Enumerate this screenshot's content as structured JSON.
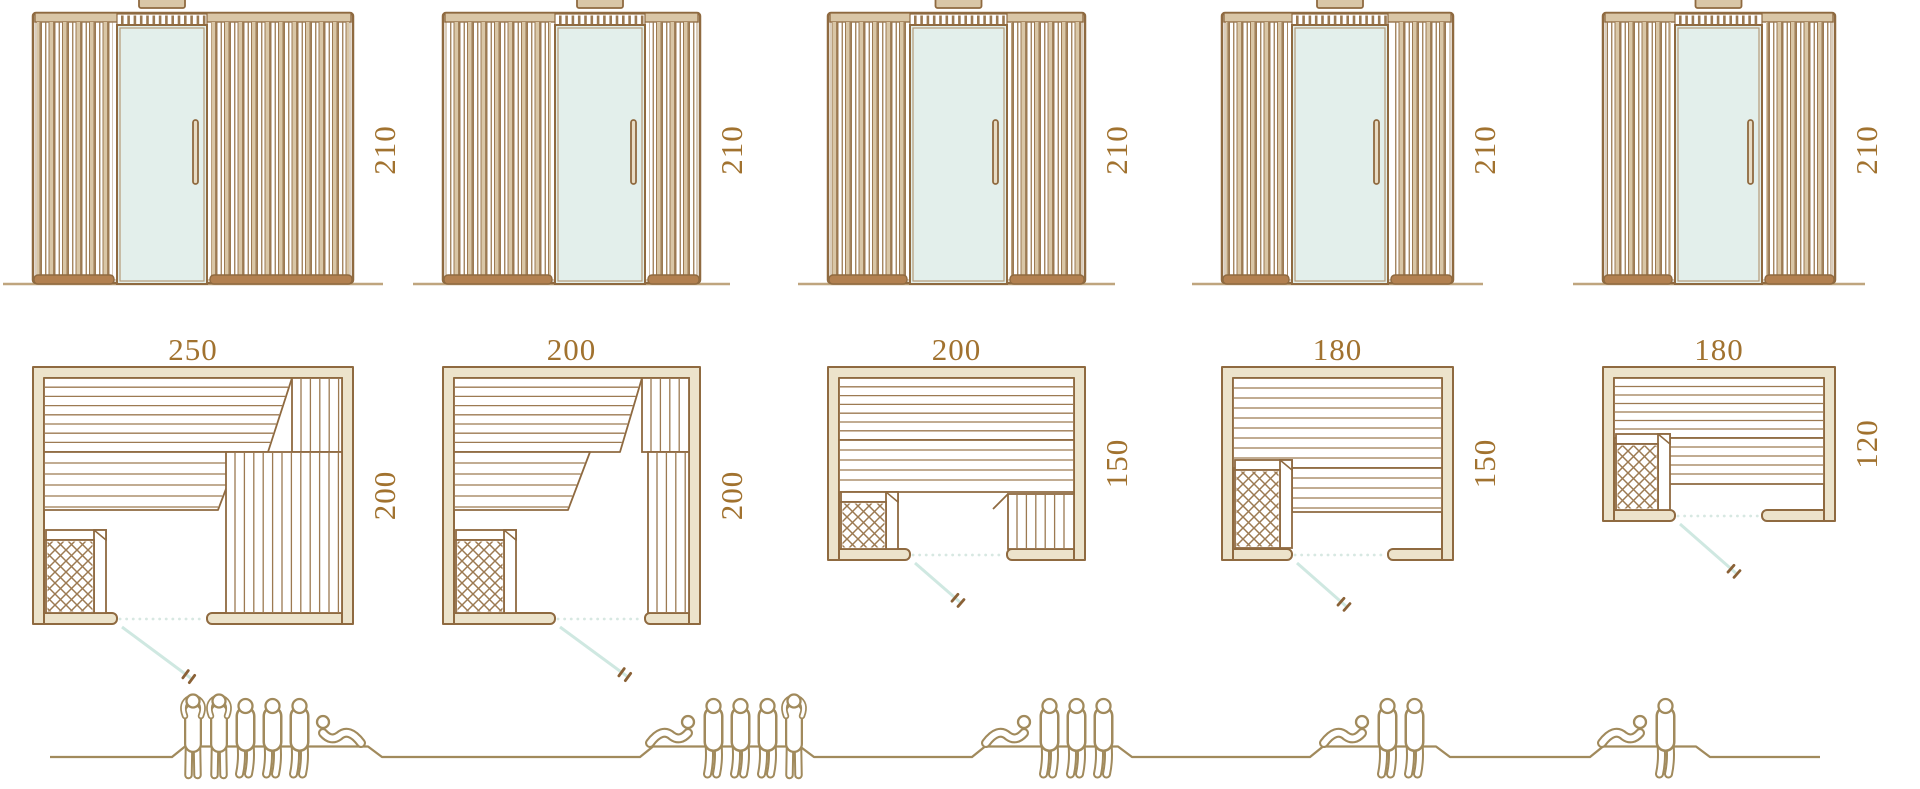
{
  "colors": {
    "outline": "#8f6a40",
    "plank_line": "#9c7a52",
    "slat_fill": "#d9c6a6",
    "wall_fill": "#ece3cb",
    "plinth": "#b28050",
    "glass": "#e3efeb",
    "door_swing": "#cfe8e1",
    "door_dotted": "#d7e8e2",
    "handle_brown": "#8a6136",
    "people": "#a18a5c",
    "ground_elevation": "#bfa57e",
    "label_text": "#a1722f",
    "background": "#ffffff"
  },
  "icons": {
    "person_standing": "person-standing-icon",
    "person_sitting": "person-sitting-icon",
    "person_lying": "person-lying-icon",
    "heater": "heater-icon",
    "glass_door": "glass-door",
    "door_handle": "door-handle-icon",
    "chimney": "chimney-vent",
    "ground": "ground-line"
  },
  "models": [
    {
      "id": "sauna-250x200",
      "elevation": {
        "height_label": "210"
      },
      "plan": {
        "width_label": "250",
        "depth_label": "200"
      },
      "capacity": {
        "standing": 2,
        "sitting": 3,
        "lying": 1,
        "total": 6
      }
    },
    {
      "id": "sauna-200x200",
      "elevation": {
        "height_label": "210"
      },
      "plan": {
        "width_label": "200",
        "depth_label": "200"
      },
      "capacity": {
        "standing": 1,
        "sitting": 3,
        "lying": 1,
        "total": 5
      }
    },
    {
      "id": "sauna-200x150",
      "elevation": {
        "height_label": "210"
      },
      "plan": {
        "width_label": "200",
        "depth_label": "150"
      },
      "capacity": {
        "standing": 0,
        "sitting": 3,
        "lying": 1,
        "total": 4
      }
    },
    {
      "id": "sauna-180x150",
      "elevation": {
        "height_label": "210"
      },
      "plan": {
        "width_label": "180",
        "depth_label": "150"
      },
      "capacity": {
        "standing": 0,
        "sitting": 2,
        "lying": 1,
        "total": 3
      }
    },
    {
      "id": "sauna-180x120",
      "elevation": {
        "height_label": "210"
      },
      "plan": {
        "width_label": "180",
        "depth_label": "120"
      },
      "capacity": {
        "standing": 0,
        "sitting": 1,
        "lying": 1,
        "total": 2
      }
    }
  ]
}
